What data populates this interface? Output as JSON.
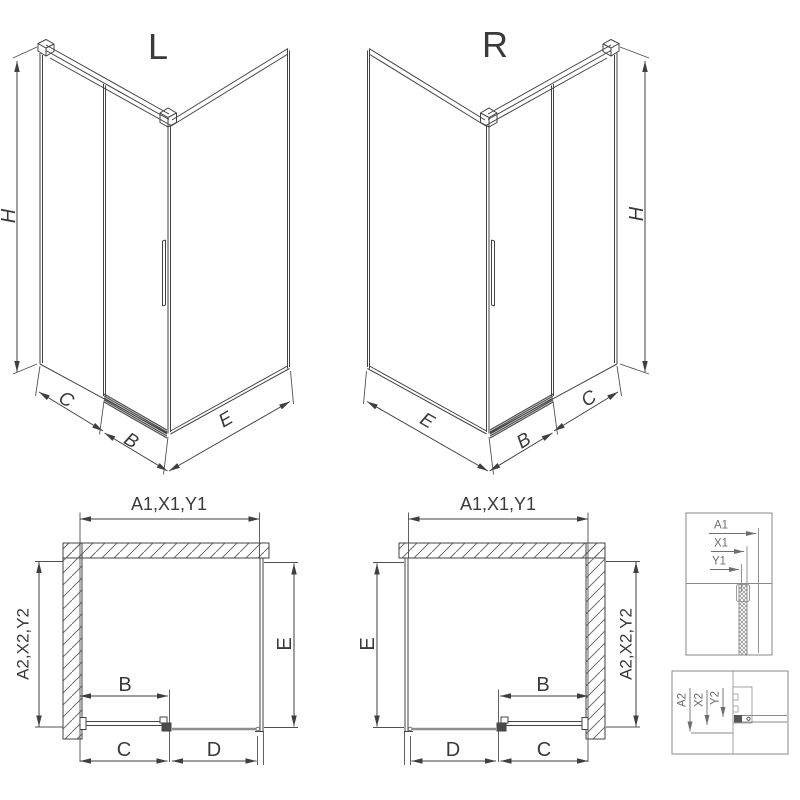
{
  "title": "Shower enclosure sliding-door technical drawing",
  "colors": {
    "line": "#3f3f3f",
    "light_line": "#8f8f8f",
    "text": "#3a3a3a",
    "detail_text": "#6e6e6e",
    "background": "#ffffff"
  },
  "iso_views": {
    "left": {
      "label": "L",
      "height_dim": "H",
      "dims": {
        "back": "C",
        "door": "B",
        "side": "E"
      }
    },
    "right": {
      "label": "R",
      "height_dim": "H",
      "dims": {
        "side": "E",
        "door": "B",
        "back": "C"
      }
    }
  },
  "plan_views": {
    "left": {
      "top_dim": "A1,X1,Y1",
      "left_dim": "A2,X2,Y2",
      "right_dim": "E",
      "door_dim": "B",
      "bottom_dims": {
        "first": "C",
        "second": "D"
      }
    },
    "right": {
      "top_dim": "A1,X1,Y1",
      "left_dim": "E",
      "right_dim": "A2,X2,Y2",
      "door_dim": "B",
      "bottom_dims": {
        "first": "D",
        "second": "C"
      }
    }
  },
  "detail_views": {
    "top": {
      "labels": [
        "A1",
        "X1",
        "Y1"
      ]
    },
    "bottom": {
      "labels": [
        "A2",
        "X2",
        "Y2"
      ]
    }
  }
}
